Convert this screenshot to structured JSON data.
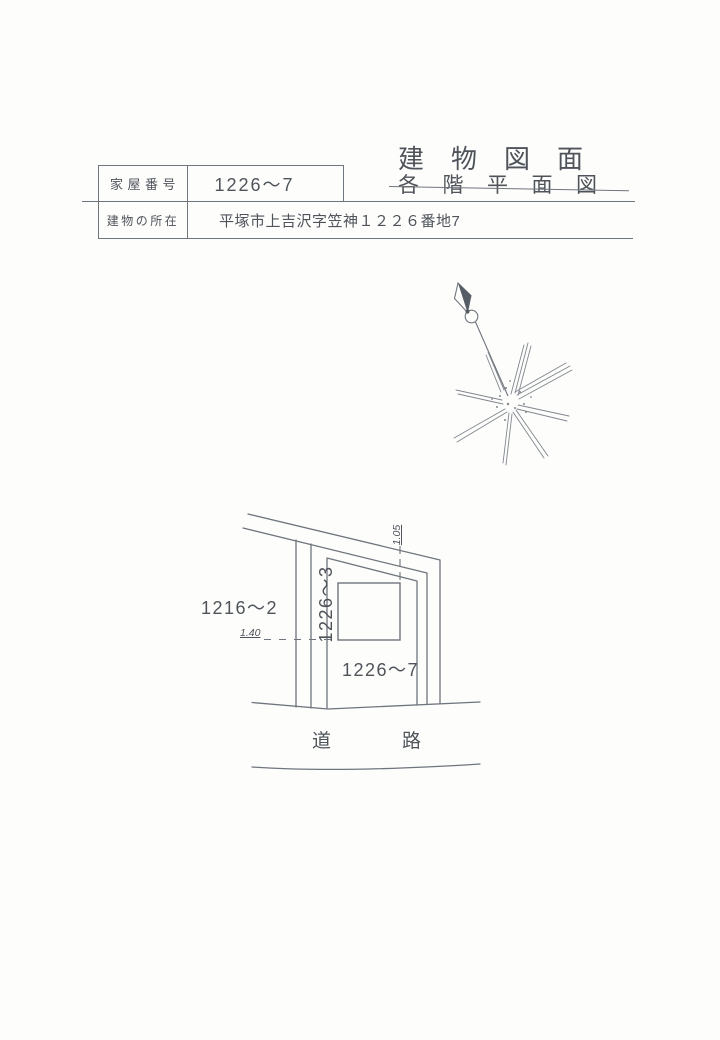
{
  "header": {
    "title_main": "建物図面",
    "title_struck": "各階平面図",
    "fields": [
      {
        "label": "家屋番号",
        "value": "1226〜7"
      },
      {
        "label": "建物の所在",
        "value": "平塚市上吉沢字笠神１２２６番地7"
      }
    ]
  },
  "compass": {
    "icon": "north-arrow"
  },
  "site_plan": {
    "lot_left": "1216〜2",
    "lot_strip": "1226〜3",
    "lot_main": "1226〜7",
    "road": "道路",
    "dim_top": "1.05",
    "dim_left": "1.40"
  },
  "colors": {
    "paper": "#fdfdfc",
    "line": "#6f757c",
    "text": "#4f545a",
    "sketch": "#81878e"
  }
}
